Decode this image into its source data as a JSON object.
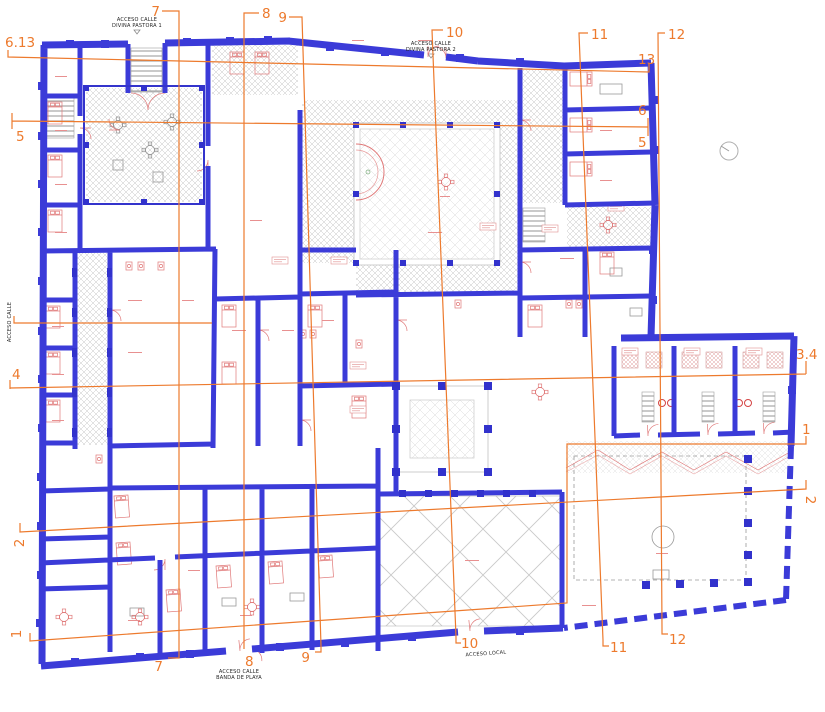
{
  "plan": {
    "background": "#ffffff",
    "colors": {
      "walls": "#3b3bd8",
      "wall_accent": "#3232cc",
      "detail_red": "#e07878",
      "section_orange": "#ed7a2d",
      "hatch_gray": "#c4c4c4",
      "tile_gray": "#c0c0c0",
      "label_black": "#222222"
    },
    "access_labels": {
      "divina_pastora_1_line1": "ACCESO CALLE",
      "divina_pastora_1_line2": "DIVINA PASTORA 1",
      "divina_pastora_2_line1": "ACCESO CALLE",
      "divina_pastora_2_line2": "DIVINA PASTORA 2",
      "left_street": "ACCESO CALLE",
      "banda_de_playa_line1": "ACCESO CALLE",
      "banda_de_playa_line2": "BANDA DE PLAYA",
      "local": "ACCESO LOCAL"
    },
    "section_markers": {
      "top_7": "7",
      "top_8": "8",
      "top_9": "9",
      "top_10": "10",
      "top_11": "11",
      "top_12": "12",
      "right_13": "13",
      "right_6": "6",
      "right_5": "5",
      "right_3_4": "3.4",
      "right_1": "1",
      "right_2": "2",
      "left_6_13": "6.13",
      "left_5": "5",
      "left_4": "4",
      "left_2": "2",
      "left_1": "1",
      "bottom_7": "7",
      "bottom_8": "8",
      "bottom_9": "9",
      "bottom_10": "10",
      "bottom_11": "11",
      "bottom_12": "12"
    },
    "icons": {
      "north_indicator": "north-circle-icon"
    }
  }
}
